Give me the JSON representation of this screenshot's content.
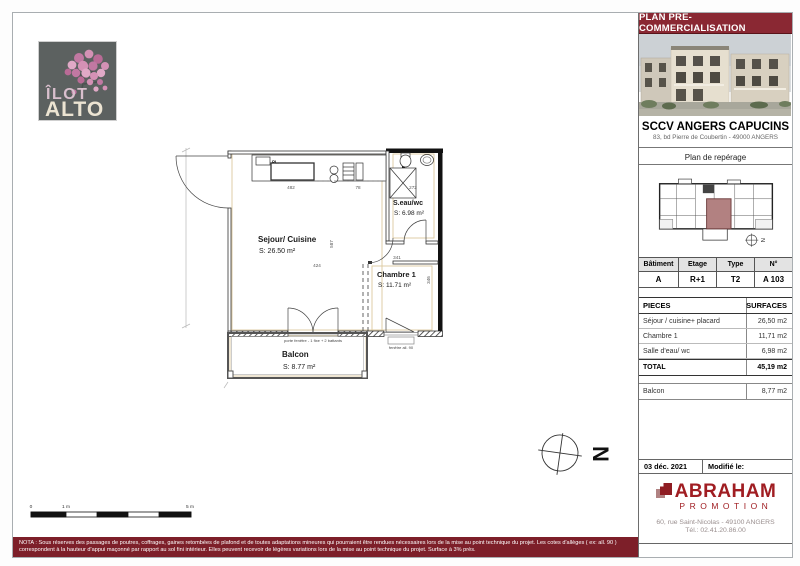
{
  "doc": {
    "banner": "PLAN PRE-COMMERCIALISATION",
    "nota": {
      "line1": "NOTA : Sous réserves des passages de poutres, coffrages, gaines retombées de plafond et de toutes adaptations mineures qui pourraient être rendues nécessaires lors de la mise au point technique du projet. Les cotes d'allèges ( ex: all. 90 )",
      "line2": "correspondent à la hauteur d'appui maçonné par rapport au sol fini intérieur. Elles peuvent recevoir de légères variations lors de la mise au point technique du projet. Surface à 3% près."
    }
  },
  "logo": {
    "top": "ÎLOT",
    "bottom": "ALTO"
  },
  "sidebar": {
    "company": "SCCV ANGERS CAPUCINS",
    "company_address": "83, bd Pierre de Coubertin - 49000 ANGERS",
    "reperage": "Plan de repérage",
    "unit": {
      "headers": [
        "Bâtiment",
        "Etage",
        "Type",
        "N°"
      ],
      "values": [
        "A",
        "R+1",
        "T2",
        "A 103"
      ]
    },
    "surfaces": {
      "col_piece": "PIECES",
      "col_surface": "SURFACES",
      "rows": [
        {
          "label": "Séjour / cuisine+ placard",
          "value": "26,50 m2"
        },
        {
          "label": "Chambre 1",
          "value": "11,71 m2"
        },
        {
          "label": "Salle d'eau/ wc",
          "value": "6,98 m2"
        }
      ],
      "total_label": "TOTAL",
      "total_value": "45,19 m2",
      "balcon_label": "Balcon",
      "balcon_value": "8,77 m2"
    },
    "date": "03 déc. 2021",
    "modified": "Modifié le:",
    "promoter": {
      "name": "ABRAHAM",
      "tagline": "PROMOTION",
      "address": "60, rue Saint-Nicolas - 49100 ANGERS",
      "phone": "Tél.: 02.41.20.86.00"
    }
  },
  "plan": {
    "sejour": {
      "name": "Sejour/ Cuisine",
      "area": "S: 26.50 m²"
    },
    "chambre": {
      "name": "Chambre 1",
      "area": "S: 11.71 m²"
    },
    "sdb": {
      "name": "S.eau/wc",
      "area": "S: 6.98 m²"
    },
    "balcon": {
      "name": "Balcon",
      "area": "S: 8.77 m²"
    },
    "pl": "PL.",
    "porte_fenetre": "porte fenêtre - 1 fixe + 2 battants",
    "fenetre": "fenêtre all. 90",
    "dims": {
      "kitchen": "482",
      "k2": "78",
      "bath": "272",
      "sejour_w": "424",
      "sejour_h": "587",
      "chambre_w": "341",
      "chambre_h": "346"
    },
    "north": "N",
    "scale": {
      "zero": "0",
      "one": "1 m",
      "five": "5 m"
    }
  },
  "colors": {
    "header_red": "#8a2833",
    "nota_red": "#7d1f29",
    "abraham_red": "#a01d22",
    "unit_highlight": "#b28181",
    "logo_gray": "#5c6160"
  }
}
